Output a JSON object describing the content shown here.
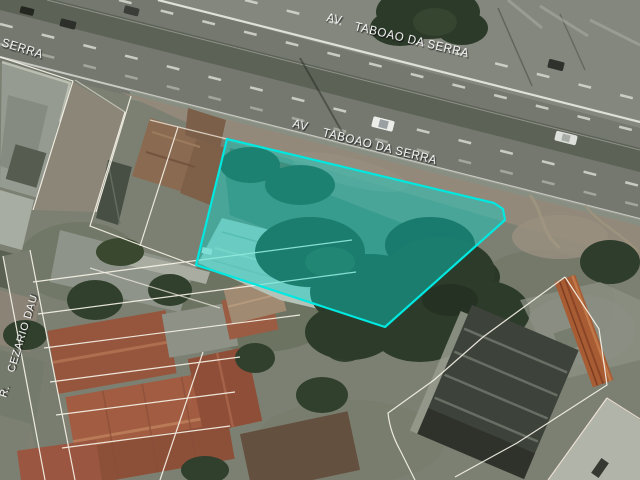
{
  "map": {
    "view_type": "satellite",
    "street_labels": {
      "avenue_abbrev": "AV",
      "avenue_name": "TABOAO DA SERRA",
      "avenue_fragment": "SERRA",
      "cross_street_abbrev": "R.",
      "cross_street_name": "CEZARIO DAU",
      "color": "#ffffff"
    },
    "highlight": {
      "description": "selected land parcel outline",
      "stroke_color": "#00e8e0",
      "fill_color": "rgba(0,216,205,0.42)"
    }
  }
}
